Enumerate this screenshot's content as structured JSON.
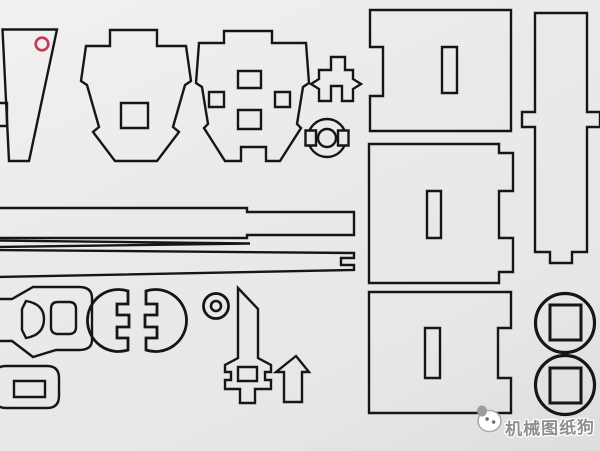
{
  "canvas": {
    "width": 600,
    "height": 451,
    "background": "#e9e9e9",
    "line_color": "#161616",
    "accent_red": "#c13b52",
    "watermark_gray": "#8f8f8f"
  },
  "watermark": {
    "text": "机械图纸狗",
    "color": "#8f8f8f",
    "outline_color": "#ffffff"
  },
  "shapes": [
    {
      "name": "part-trapezoid-panel",
      "d": "M 2.5,29.5 L 57,29.5 L 29,161 L 9,161 Z"
    },
    {
      "name": "part-trapezoid-edge-slot",
      "d": "M -4,103 H 7 V 126 H -4 Z"
    },
    {
      "name": "registration-red-circle",
      "d": "M 35.7,44 a 6.3,6.3 0 1,0 12.6,0 a 6.3,6.3 0 1,0 -12.6,0 Z",
      "stroke": "#c13b52",
      "w": 2.6
    },
    {
      "name": "part-bulkhead-former-1",
      "d": "M 110,30 H 157 V 46 H 186 L 191,81 L 185,85 L 173,127 L 179,132 L 157,161 H 115 L 93,132 L 99,127 L 87,85 L 81,81 L 86,46 H 110 Z"
    },
    {
      "name": "part-bulkhead-former-1-hole",
      "d": "M 121,103 H 148 V 128 H 121 Z"
    },
    {
      "name": "part-bulkhead-former-2",
      "d": "M 224,31 H 272 V 43 H 306 L 309,83 L 303,87 L 297,124 L 301,128 L 280,161 H 266 V 147 H 241 V 161 H 225 L 204,128 L 208,124 L 202,87 L 196,83 L 199,43 H 224 Z"
    },
    {
      "name": "part-bulkhead-former-2-hole-top",
      "d": "M 238,71 H 261 V 88 H 238 Z"
    },
    {
      "name": "part-bulkhead-former-2-hole-left",
      "d": "M 209,92 H 224 V 107 H 209 Z"
    },
    {
      "name": "part-bulkhead-former-2-hole-right",
      "d": "M 275,92 H 290 V 107 H 275 Z"
    },
    {
      "name": "part-bulkhead-former-2-hole-bottom",
      "d": "M 238,110 H 261 V 129 H 238 Z"
    },
    {
      "name": "part-crown-bracket",
      "d": "M 331,57 H 345 V 70 H 353 V 79 L 361,84 L 353,89 V 101 H 342 V 86 H 331 V 101 H 319 V 89 L 311,84 L 319,79 V 70 H 331 Z"
    },
    {
      "name": "part-notched-ring-outer",
      "d": "M 308,138 a 19,19 0 1,0 38,0 a 19,19 0 1,0 -38,0 Z"
    },
    {
      "name": "part-notched-ring-notch-left",
      "d": "M 305.5,130.5 H 316 V 145.5 H 305.5 Z",
      "fill": "#e9e9e9"
    },
    {
      "name": "part-notched-ring-notch-right",
      "d": "M 338,130.5 H 348.5 V 145.5 H 338 Z",
      "fill": "#e9e9e9"
    },
    {
      "name": "part-notched-ring-inner",
      "d": "M 318,138 a 9,9 0 1,0 18,0 a 9,9 0 1,0 -18,0 Z"
    },
    {
      "name": "part-panel-1",
      "d": "M 370,10 H 511 V 131 H 370 V 96 H 383 V 47 H 370 Z"
    },
    {
      "name": "part-panel-1-slot",
      "d": "M 442,47 H 457 V 93 H 442 Z"
    },
    {
      "name": "part-panel-2",
      "d": "M 369,144 H 499 V 153 H 513 V 191 H 499 V 238 H 513 V 272 H 499 V 283 H 369 Z"
    },
    {
      "name": "part-panel-2-slot",
      "d": "M 427,191 H 441 V 238 H 427 Z"
    },
    {
      "name": "part-panel-3",
      "d": "M 369,292 H 511 V 328 H 498 V 378 H 511 V 413 H 369 Z"
    },
    {
      "name": "part-panel-3-slot",
      "d": "M 425,328 H 440 V 378 H 425 Z"
    },
    {
      "name": "part-tall-spar",
      "d": "M 535,13 H 587 V 112 H 600 V 127 H 587 V 252 H 572 V 263 H 550 V 252 H 535 V 127 H 522 V 112 H 535 Z"
    },
    {
      "name": "part-long-strip-stepped",
      "d": "M -3,208 H 247 V 212 H 354 V 235 H 247 V 238 H -3 Z"
    },
    {
      "name": "part-long-strip-thin",
      "d": "M -3,240.5 L 250,243.5 L -3,247 Z"
    },
    {
      "name": "part-long-strip-notched",
      "d": "M -3,250 L 354,253 V 258 H 341 V 265 H 354 V 270 L -3,277 Z"
    },
    {
      "name": "part-buckle-body",
      "d": "M -3,299 H 12 L 33,287 H 79 Q 92,287 92,298 V 340 Q 92,350 79,350 H 56 L 33,357 L 12,341 H -3 Z"
    },
    {
      "name": "part-buckle-d-hole",
      "d": "M 26,301 Q 44,304 44,319 Q 44,335 26,338 L 22,330 V 309 Z"
    },
    {
      "name": "part-buckle-square-hole",
      "d": "M 58,302 H 69 Q 76,302 76,309 V 327 Q 76,334 69,334 H 58 Q 51,334 51,327 V 309 Q 51,302 58,302 Z"
    },
    {
      "name": "part-half-disc-left",
      "d": "M 128,291 A 31,31 0 1,0 128,350 V 338 H 117 V 327 H 129 V 315 H 117 V 304 H 128 Z",
      "w": 2.8
    },
    {
      "name": "part-half-disc-right",
      "d": "M 146,291 A 31,31 0 1,1 146,350 V 338 H 157 V 327 H 145 V 315 H 157 V 304 H 146 Z",
      "w": 2.8
    },
    {
      "name": "part-grommet-outer",
      "d": "M 203.5,306 a 12.5,12.5 0 1,0 25,0 a 12.5,12.5 0 1,0 -25,0 Z",
      "w": 2.8
    },
    {
      "name": "part-grommet-inner",
      "d": "M 211,306 a 5,5 0 1,0 10,0 a 5,5 0 1,0 -10,0 Z",
      "w": 2.6
    },
    {
      "name": "part-rounded-plate",
      "d": "M 6,366 H 47 Q 59,366 59,378 V 396 Q 59,408 47,408 H 6 Q -6,408 -6,396 V 378 Q -6,366 6,366 Z"
    },
    {
      "name": "part-rounded-plate-hole",
      "d": "M 14,381 H 45 V 397 H 14 Z"
    },
    {
      "name": "part-sword-keel",
      "d": "M 238,288 L 258,309 V 358 L 271,365 V 372 H 265 V 380 H 271 V 389 H 255 V 403 H 240 V 389 H 225 V 380 H 231 V 372 H 225 V 365 L 238,358 Z"
    },
    {
      "name": "part-sword-keel-hole",
      "d": "M 238,367 H 257 V 381 H 238 Z"
    },
    {
      "name": "part-bent-arrow",
      "d": "M 296,356 L 309,372 H 302 V 402 H 284 V 372 H 276 Z"
    },
    {
      "name": "part-wheel-1",
      "d": "M 535.5,323 a 29.5,29.5 0 1,0 59,0 a 29.5,29.5 0 1,0 -59,0 Z",
      "w": 3.2
    },
    {
      "name": "part-wheel-1-hub-hole",
      "d": "M 550,305 H 581 V 340 H 550 Z",
      "w": 3
    },
    {
      "name": "part-wheel-2",
      "d": "M 535.5,385 a 29.5,29.5 0 1,0 59,0 a 29.5,29.5 0 1,0 -59,0 Z",
      "w": 3.2
    },
    {
      "name": "part-wheel-2-hub-hole",
      "d": "M 550,368 H 581 V 403 H 550 Z",
      "w": 3
    },
    {
      "name": "dog-mascot-head",
      "d": "M 478,421 a 11.5,10.5 0 1,0 23,0 a 11.5,10.5 0 1,0 -23,0 Z",
      "fill": "#ffffff",
      "stroke": "#ababab",
      "w": 1.6
    },
    {
      "name": "dog-mascot-ear",
      "d": "M 477.5,411 a 4.5,5 0 1,0 9,0 a 4.5,5 0 1,0 -9,0 Z",
      "fill": "#9c9c9c",
      "stroke": "#9c9c9c",
      "w": 1
    },
    {
      "name": "dog-mascot-eye-left",
      "d": "M 485.5,419 a 1.6,1.6 0 1,0 3.2,0 a 1.6,1.6 0 1,0 -3.2,0 Z",
      "fill": "#6f6f6f",
      "stroke": "#6f6f6f",
      "w": 0.5
    },
    {
      "name": "dog-mascot-eye-right",
      "d": "M 492,422 a 1.6,1.6 0 1,0 3.2,0 a 1.6,1.6 0 1,0 -3.2,0 Z",
      "fill": "#6f6f6f",
      "stroke": "#6f6f6f",
      "w": 0.5
    }
  ]
}
